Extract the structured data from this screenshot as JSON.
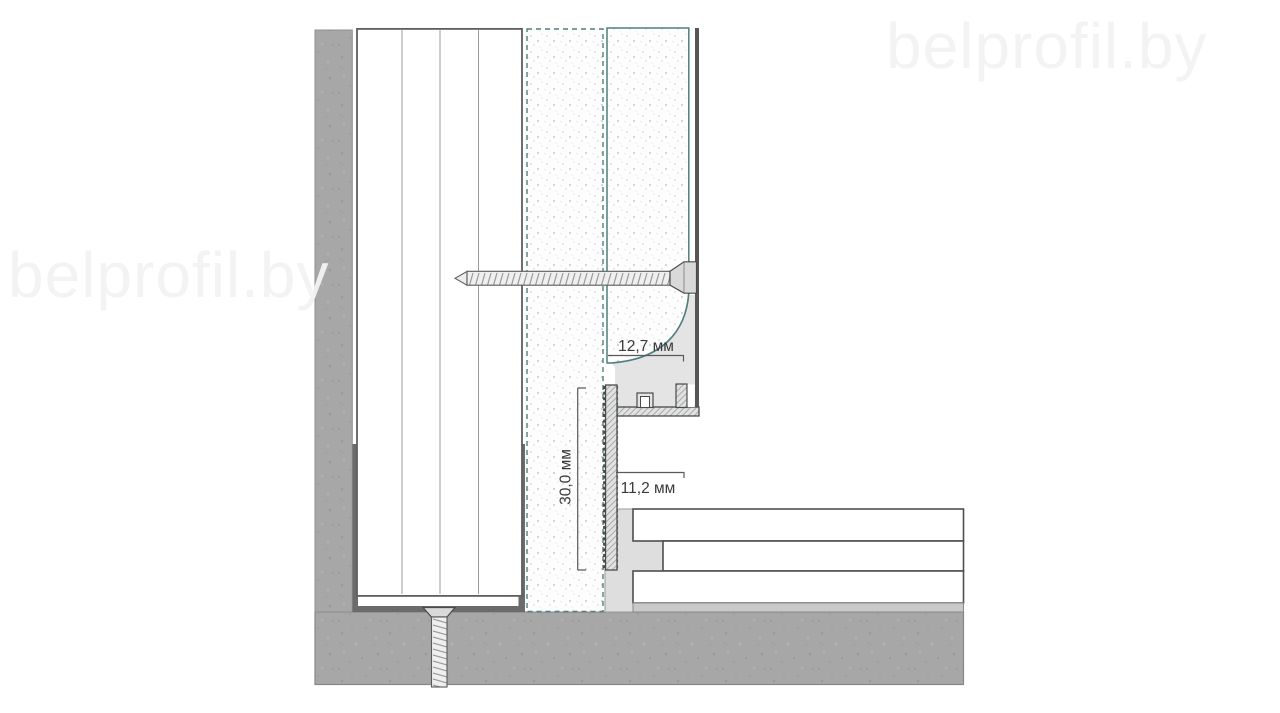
{
  "watermark": {
    "left": "belprofil.by",
    "top_right": "belprofil.by"
  },
  "dimensions": {
    "cove_width": "12,7 мм",
    "flange_height": "30,0 мм",
    "gap_depth": "11,2 мм"
  },
  "colors": {
    "teal_accent": "#4e7f7c",
    "concrete_gray": "#a7a7a7",
    "profile_aluminum": "#e4e4e4",
    "outline_dark": "#4a4a4a",
    "track_gray": "#6b6b6b",
    "dimension_text": "#3a3a3a",
    "watermark_gray": "#f2f2f2"
  }
}
